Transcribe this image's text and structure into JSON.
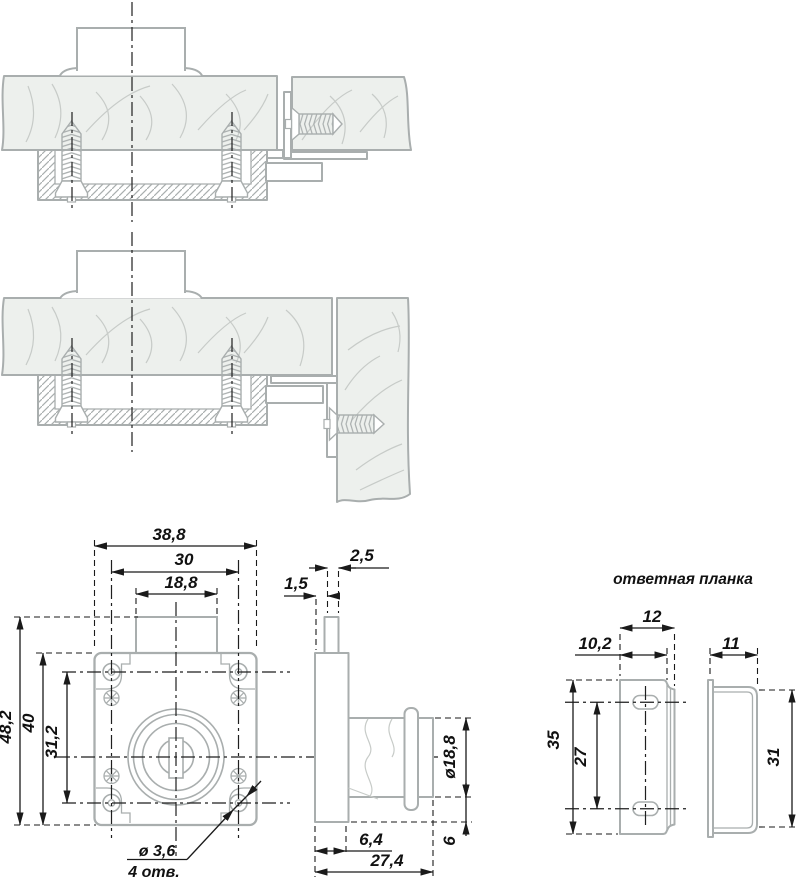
{
  "drawing": {
    "strike_plate_title": "ответная планка",
    "front_view": {
      "width_total": "38,8",
      "width_holes": "30",
      "width_cylinder": "18,8",
      "height_total": "48,2",
      "height_body": "40",
      "height_holes": "31,2",
      "hole_dia_note": "ø 3,6",
      "hole_count_note": "4 отв."
    },
    "side_view": {
      "latch_offset": "1,5",
      "latch_thickness": "2,5",
      "cylinder_dia": "ø18,8",
      "case_depth": "6,4",
      "base_height": "6",
      "total_depth": "27,4"
    },
    "strike_view": {
      "width": "12",
      "bend_offset": "10,2",
      "side_depth": "11",
      "height": "35",
      "hole_spacing": "27",
      "side_height": "31"
    }
  }
}
